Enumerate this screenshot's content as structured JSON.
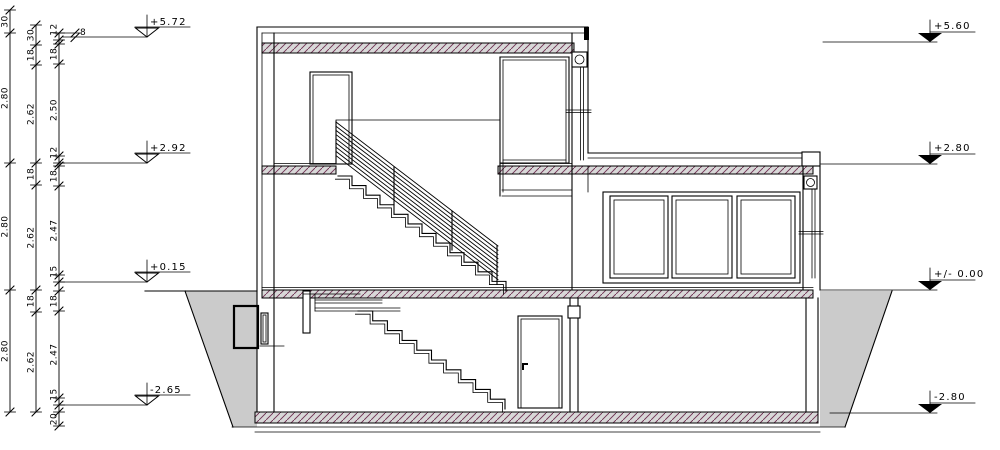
{
  "drawing": {
    "type": "architectural-building-section",
    "colors": {
      "line": "#000000",
      "slab_fill": "#d8d8d8",
      "hatch_line": "#6d2e50",
      "earth_fill": "#cbcbcb",
      "background": "#ffffff"
    },
    "levels_left": [
      {
        "label": "+5.72",
        "y": 37
      },
      {
        "label": "+2.92",
        "y": 163
      },
      {
        "label": "+0.15",
        "y": 282
      },
      {
        "label": "-2.65",
        "y": 405
      }
    ],
    "levels_right": [
      {
        "label": "+5.60",
        "y": 42
      },
      {
        "label": "+2.80",
        "y": 164
      },
      {
        "label": "+/- 0.00",
        "y": 290
      },
      {
        "label": "-2.80",
        "y": 413
      }
    ],
    "dim_columns": [
      {
        "x": 10,
        "segments": [
          {
            "from": 10,
            "to": 33,
            "label": "30"
          },
          {
            "from": 33,
            "to": 163,
            "label": "2.80"
          },
          {
            "from": 163,
            "to": 290,
            "label": "2.80"
          },
          {
            "from": 290,
            "to": 412,
            "label": "2.80"
          }
        ]
      },
      {
        "x": 36,
        "segments": [
          {
            "from": 25,
            "to": 45,
            "label": "30"
          },
          {
            "from": 45,
            "to": 65,
            "label": "18"
          },
          {
            "from": 65,
            "to": 163,
            "label": "2.62"
          },
          {
            "from": 163,
            "to": 185,
            "label": "18"
          },
          {
            "from": 185,
            "to": 290,
            "label": "2.62"
          },
          {
            "from": 290,
            "to": 312,
            "label": "18"
          },
          {
            "from": 312,
            "to": 412,
            "label": "2.62"
          }
        ]
      },
      {
        "x": 59,
        "segments": [
          {
            "from": 33,
            "to": 40,
            "label": "12"
          },
          {
            "from": 44,
            "to": 64,
            "label": "18"
          },
          {
            "from": 64,
            "to": 156,
            "label": "2.50"
          },
          {
            "from": 156,
            "to": 163,
            "label": "12"
          },
          {
            "from": 166,
            "to": 186,
            "label": "18"
          },
          {
            "from": 186,
            "to": 275,
            "label": "2.47"
          },
          {
            "from": 275,
            "to": 282,
            "label": "15"
          },
          {
            "from": 291,
            "to": 311,
            "label": "18"
          },
          {
            "from": 311,
            "to": 398,
            "label": "2.47"
          },
          {
            "from": 398,
            "to": 405,
            "label": "15"
          },
          {
            "from": 412,
            "to": 426,
            "label": "20"
          }
        ]
      }
    ],
    "small_dim": {
      "label": "8"
    }
  }
}
